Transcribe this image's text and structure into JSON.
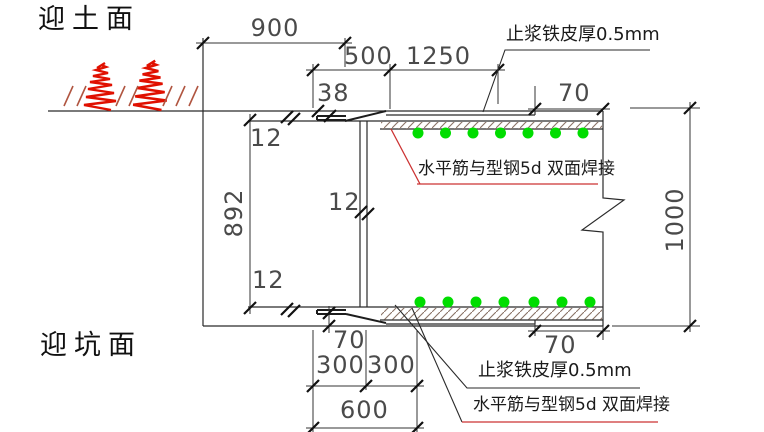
{
  "drawing": {
    "labels": {
      "soil_side": "迎土面",
      "pit_side": "迎坑面",
      "sheet_top": "止浆铁皮厚0.5mm",
      "weld_top": "水平筋与型钢5d 双面焊接",
      "sheet_bottom": "止浆铁皮厚0.5mm",
      "weld_bottom": "水平筋与型钢5d 双面焊接"
    },
    "dimensions": {
      "d900": "900",
      "d500": "500",
      "d1250": "1250",
      "d38": "38",
      "d70_top": "70",
      "d12_top": "12",
      "d892": "892",
      "d12_mid": "12",
      "d1000": "1000",
      "d12_bottom": "12",
      "d70_bottom_left": "70",
      "d70_bottom_right": "70",
      "d300_left": "300",
      "d300_right": "300",
      "d600": "600"
    },
    "colors": {
      "rebar_green": "#00dd00",
      "soil_red": "#e01000",
      "soil_hatch": "#b05540",
      "leader_red": "#cc3333",
      "line_black": "#2a2a2a"
    }
  }
}
